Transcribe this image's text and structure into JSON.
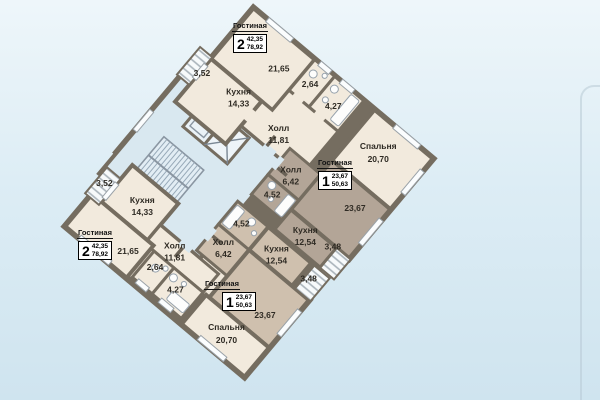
{
  "colors": {
    "wall": "#756d60",
    "apt2_fill": "#f2eadd",
    "apt1_upper_fill": "#b3a597",
    "apt1_lower_fill": "#cfc0ae",
    "common_fill": "#d9e8f0"
  },
  "apartments": {
    "apt2_top": {
      "badge": {
        "room_label": "Гостиная",
        "rooms_count": "2",
        "living_area": "42,35",
        "total_area": "78,92"
      },
      "living_area": "21,65",
      "wc_area": "2,64",
      "bath_area": "4,27",
      "kitchen": {
        "name": "Кухня",
        "area": "14,33"
      },
      "hall": {
        "name": "Холл",
        "area": "11,81"
      },
      "bedroom": {
        "name": "Спальня",
        "area": "20,70"
      },
      "balcony_area": "3,52"
    },
    "apt1_upper": {
      "badge": {
        "room_label": "Гостиная",
        "rooms_count": "1",
        "living_area": "23,67",
        "total_area": "50,63"
      },
      "living_area": "23,67",
      "bath_area": "4,52",
      "kitchen": {
        "name": "Кухня",
        "area": "12,54"
      },
      "hall": {
        "name": "Холл",
        "area": "6,42"
      },
      "balcony_area": "3,48"
    },
    "apt1_lower": {
      "badge": {
        "room_label": "Гостиная",
        "rooms_count": "1",
        "living_area": "23,67",
        "total_area": "50,63"
      },
      "living_area": "23,67",
      "bath_area": "4,52",
      "kitchen": {
        "name": "Кухня",
        "area": "12,54"
      },
      "hall": {
        "name": "Холл",
        "area": "6,42"
      },
      "balcony_area": "3,48"
    },
    "apt2_bottom": {
      "badge": {
        "room_label": "Гостиная",
        "rooms_count": "2",
        "living_area": "42,35",
        "total_area": "78,92"
      },
      "living_area": "21,65",
      "wc_area": "2,64",
      "bath_area": "4,27",
      "kitchen": {
        "name": "Кухня",
        "area": "14,33"
      },
      "hall": {
        "name": "Холл",
        "area": "11,81"
      },
      "bedroom": {
        "name": "Спальня",
        "area": "20,70"
      },
      "balcony_area": "3,52"
    }
  }
}
